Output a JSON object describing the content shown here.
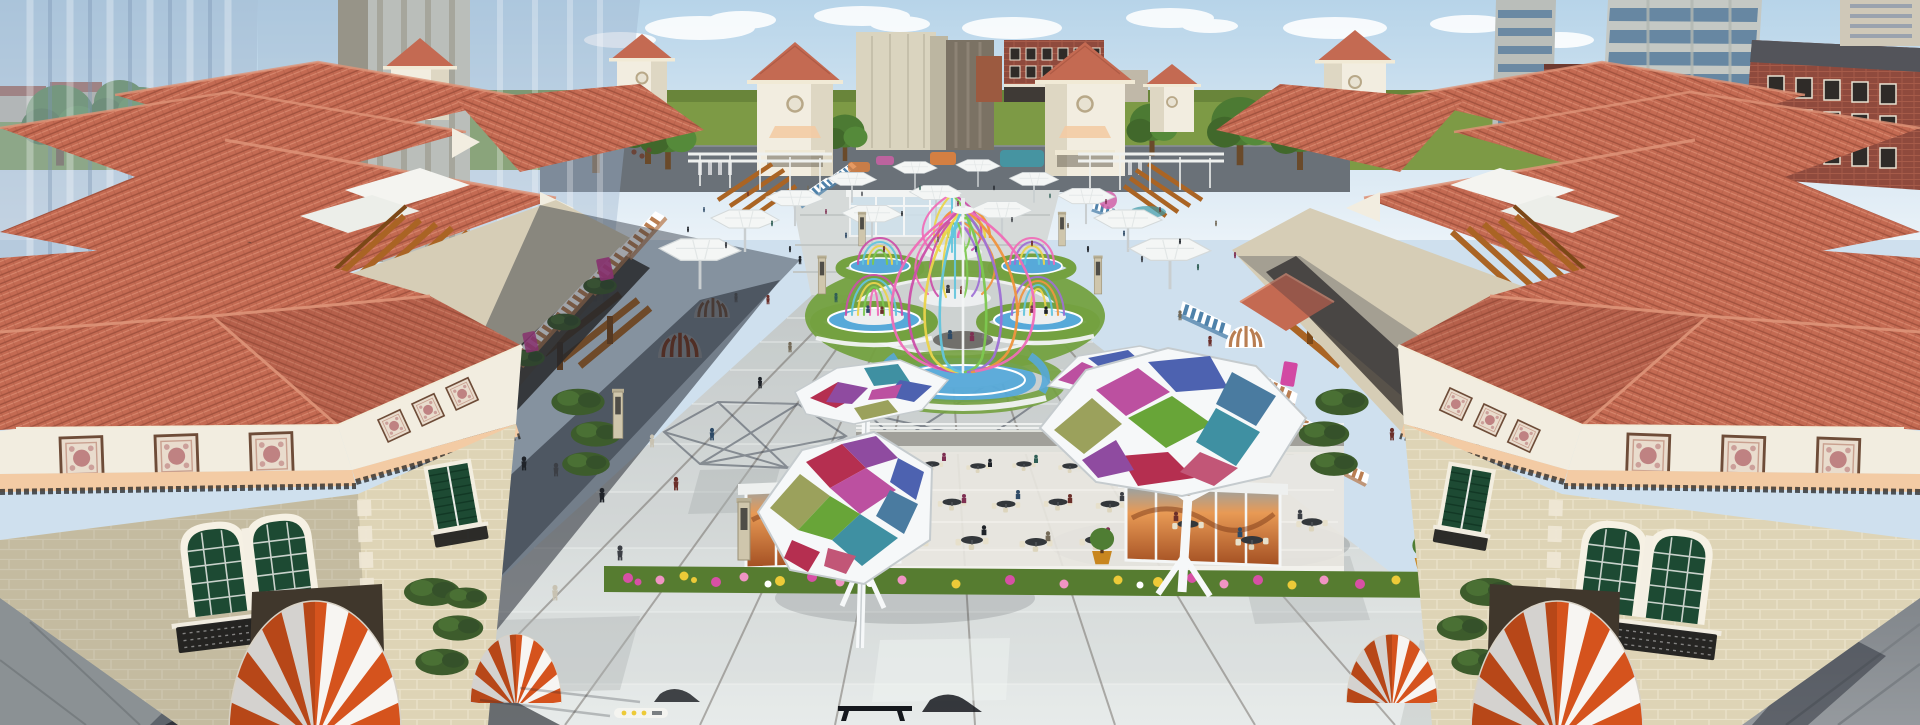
{
  "meta": {
    "title": "Aerial 3D rendering — Mediterranean open-air shopping village plaza",
    "description": "Architectural visualization: terracotta-tile-roofed retail buildings with striped awnings, wood pergolas and wrought-iron balconies flank a long stone-paved pedestrian plaza crowded with shoppers. Centerpiece lawn medallion holds rainbow birdcage dining pavilions ringed by blue pools and white benches. Stained-glass hexagonal canopies shade an outdoor cafe with flower beds and glass kiosks. Red-and-white dome awnings mark the foreground storefronts; translucent glass high-rises, brick apartment blocks and a green horizon sit under a pale blue sky with clouds."
  },
  "colors": {
    "sky_top": "#b7d4e9",
    "sky_bottom": "#eaf2f8",
    "cloud": "#ffffff",
    "grass": "#7d9a45",
    "grass_dark": "#5a7531",
    "road": "#6a7178",
    "roof": "#c46a52",
    "roof_light": "#de9378",
    "roof_dark": "#a1523e",
    "cream": "#f2ede0",
    "cream_shade": "#d6cdb6",
    "stone": "#ded4b6",
    "stone_line": "#ece4cc",
    "stone_shade": "#c0b494",
    "peach": "#f3cba4",
    "ornament": "#b06468",
    "iron": "#1f1f1f",
    "awning_red": "#d5531d",
    "awning_blue": "#4f82aa",
    "awning_tan": "#b97e52",
    "pergola": "#aa6424",
    "pergola_dark": "#7c4817",
    "pave_light": "#e3e7e6",
    "pave_mid": "#c9cecd",
    "pave_dark": "#aeb4b3",
    "pave_joint": "#6f6862",
    "shadow": "#1f2531",
    "shadow_deep": "#14171e",
    "lawn": "#74a140",
    "pool": "#57a9d9",
    "pool_dark": "#3d89ba",
    "glass_red": "#b52f50",
    "glass_purple": "#8f4ba0",
    "glass_magenta": "#bc50a0",
    "glass_blue": "#4d62b0",
    "glass_steel": "#4a7ba0",
    "glass_green": "#68a538",
    "glass_olive": "#9ba15c",
    "glass_teal": "#3f90a2",
    "glass_pink": "#c25677",
    "frame": "#f6f8f9",
    "rib_pink": "#f06cb8",
    "rib_magenta": "#cc4fa9",
    "rib_yellow": "#ebd44b",
    "rib_cyan": "#63c5dd",
    "rib_green": "#7dc94f",
    "rib_orange": "#f0953f",
    "rib_purple": "#9e6fd5",
    "flower_magenta": "#d750a5",
    "flower_pink": "#f094c3",
    "flower_yellow": "#edca38",
    "brick": "#8f4a3d",
    "brick_light": "#a65b49",
    "concrete": "#babeba",
    "window_band": "#5e809f",
    "ghost_glass": "#9eb4cc",
    "window_green": "#1d4a33",
    "kiosk_glow": "#d98b4e",
    "lamp_post": "#cfc6ac"
  },
  "scene": {
    "landmarks": [
      {
        "id": "plaza",
        "label": "central pedestrian plaza with stone paving"
      },
      {
        "id": "birdcage-pavilions",
        "label": "rainbow birdcage dining pavilions on lawn medallion"
      },
      {
        "id": "glass-canopies",
        "label": "stained-glass hexagonal cafe canopies"
      },
      {
        "id": "cafe-terrace",
        "label": "outdoor cafe with tables, kiosks and flower beds"
      },
      {
        "id": "dome-awnings",
        "label": "red-and-white striped dome awnings"
      },
      {
        "id": "gateway-towers",
        "label": "cream towers with red pyramid roofs"
      },
      {
        "id": "background-towers",
        "label": "glass and brick high-rise background"
      }
    ]
  }
}
